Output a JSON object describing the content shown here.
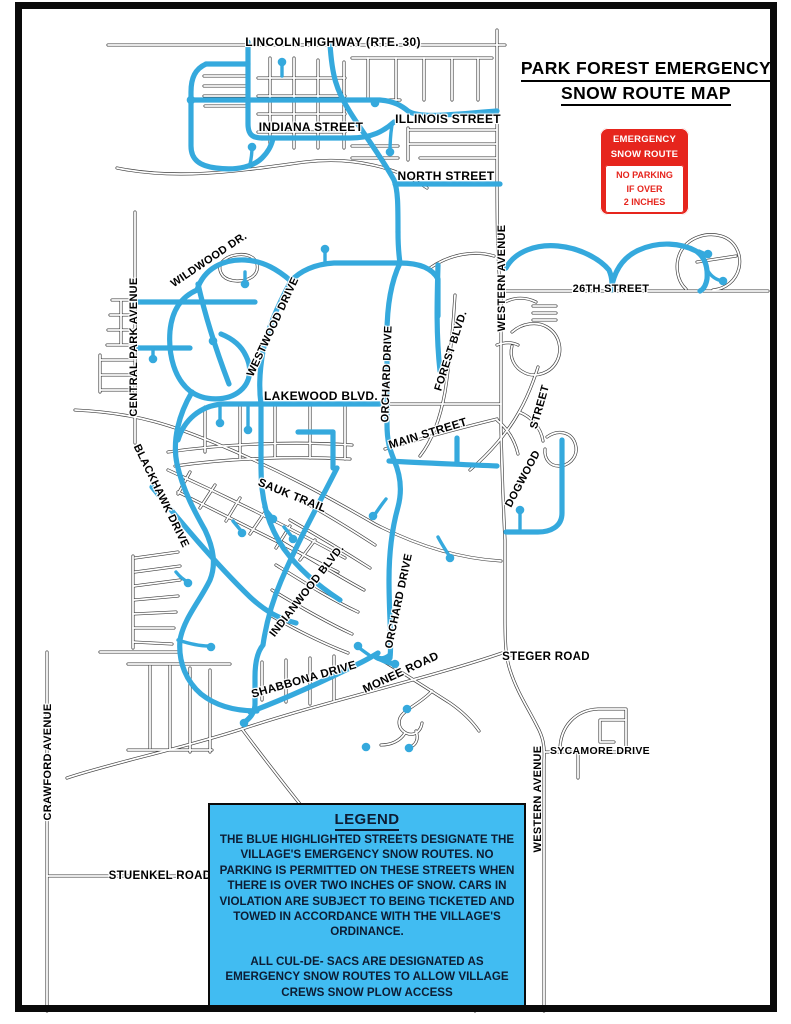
{
  "title": {
    "line1": "PARK FOREST EMERGENCY",
    "line2": "SNOW ROUTE MAP"
  },
  "sign": {
    "top_line1": "EMERGENCY",
    "top_line2": "SNOW ROUTE",
    "bottom_line1": "NO PARKING",
    "bottom_line2": "IF OVER",
    "bottom_line3": "2 INCHES"
  },
  "legend": {
    "heading": "LEGEND",
    "paragraph1": "THE BLUE HIGHLIGHTED STREETS DESIGNATE THE VILLAGE'S  EMERGENCY SNOW ROUTES. NO PARKING IS PERMITTED ON THESE STREETS WHEN THERE IS OVER TWO INCHES OF SNOW. CARS IN VIOLATION ARE SUBJECT TO BEING TICKETED AND TOWED IN ACCORDANCE WITH THE VILLAGE'S ORDINANCE.",
    "paragraph2": "ALL CUL-DE- SACS ARE DESIGNATED AS EMERGENCY SNOW ROUTES TO ALLOW VILLAGE CREWS SNOW PLOW ACCESS"
  },
  "colors": {
    "route_blue": "#35A9DD",
    "legend_blue": "#41BCF2",
    "sign_red": "#E6251D",
    "road_casing": "#3C3C3C"
  },
  "street_labels": [
    {
      "id": "lincoln-highway",
      "text": "LINCOLN HIGHWAY (RTE. 30)"
    },
    {
      "id": "indiana-street",
      "text": "INDIANA STREET"
    },
    {
      "id": "illinois-street",
      "text": "ILLINOIS STREET"
    },
    {
      "id": "north-street",
      "text": "NORTH STREET"
    },
    {
      "id": "wildwood-dr",
      "text": "WILDWOOD DR."
    },
    {
      "id": "westwood-drive",
      "text": "WESTWOOD DRIVE"
    },
    {
      "id": "central-park-avenue",
      "text": "CENTRAL PARK AVENUE"
    },
    {
      "id": "western-avenue-north",
      "text": "WESTERN AVENUE"
    },
    {
      "id": "26th-street",
      "text": "26TH STREET"
    },
    {
      "id": "forest-blvd",
      "text": "FOREST BLVD."
    },
    {
      "id": "orchard-drive-north",
      "text": "ORCHARD DRIVE"
    },
    {
      "id": "lakewood-blvd",
      "text": "LAKEWOOD BLVD."
    },
    {
      "id": "main-street",
      "text": "MAIN STREET"
    },
    {
      "id": "dogwood-street-word-street",
      "text": "STREET"
    },
    {
      "id": "dogwood-street-word-dogwood",
      "text": "DOGWOOD"
    },
    {
      "id": "sauk-trail",
      "text": "SAUK TRAIL"
    },
    {
      "id": "blackhawk-drive",
      "text": "BLACKHAWK DRIVE"
    },
    {
      "id": "indianwood-blvd",
      "text": "INDIANWOOD BLVD."
    },
    {
      "id": "orchard-drive-south",
      "text": "ORCHARD DRIVE"
    },
    {
      "id": "shabbona-drive",
      "text": "SHABBONA DRIVE"
    },
    {
      "id": "monee-road",
      "text": "MONEE ROAD"
    },
    {
      "id": "steger-road",
      "text": "STEGER ROAD"
    },
    {
      "id": "sycamore-drive",
      "text": "SYCAMORE DRIVE"
    },
    {
      "id": "western-avenue-south",
      "text": "WESTERN AVENUE"
    },
    {
      "id": "crawford-avenue",
      "text": "CRAWFORD AVENUE"
    },
    {
      "id": "stuenkel-road",
      "text": "STUENKEL ROAD"
    }
  ]
}
